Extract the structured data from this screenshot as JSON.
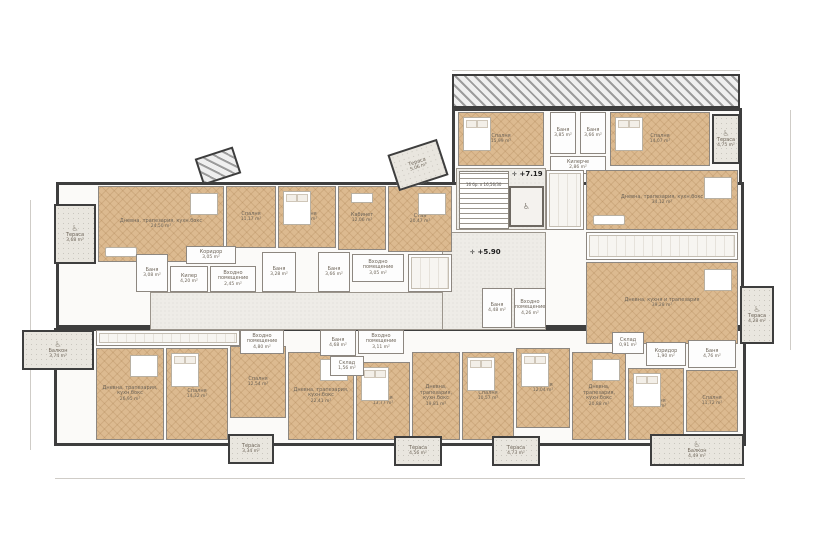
{
  "plan": {
    "title": "Floor plan",
    "unit": "m²",
    "icons": {
      "wheelchair": "♿",
      "marker": "✛",
      "lift": "♿"
    },
    "markers": [
      {
        "label": "+7.19"
      },
      {
        "label": "+5.90"
      }
    ],
    "stairs_note": "16 бр. х 16,56/30",
    "colors": {
      "wood_floor": "#dcba90",
      "wall": "#3e3e3e",
      "terrace": "#e9e6df",
      "common": "#eeece7",
      "bath": "#fdfdfd"
    },
    "rooms": [
      {
        "name": "Спалня",
        "area": "15,99 m²"
      },
      {
        "name": "Баня",
        "area": "3,85 m²"
      },
      {
        "name": "Баня",
        "area": "3,66 m²"
      },
      {
        "name": "Килерче",
        "area": "2,86 m²"
      },
      {
        "name": "Спалня",
        "area": "14,07 m²"
      },
      {
        "name": "Тераса",
        "area": "4,75 m²"
      },
      {
        "name": "Дневна, трапезария, кухн.бокс",
        "area": "34,12 m²"
      },
      {
        "name": "Дневна, кухня и трапезария",
        "area": "39,28 m²"
      },
      {
        "name": "Тераса",
        "area": "4,28 m²"
      },
      {
        "name": "Тераса",
        "area": "3,68 m²"
      },
      {
        "name": "Дневна, трапезария, кухн.бокс",
        "area": "24,50 m²"
      },
      {
        "name": "Спалня",
        "area": "11,17 m²"
      },
      {
        "name": "Спалня",
        "area": "15,57 m²"
      },
      {
        "name": "Кабинет",
        "area": "12,06 m²"
      },
      {
        "name": "Стая",
        "area": "20,47 m²"
      },
      {
        "name": "Тераса",
        "area": "5,06 m²"
      },
      {
        "name": "Коридор",
        "area": "3,05 m²"
      },
      {
        "name": "Килер",
        "area": "4,20 m²"
      },
      {
        "name": "Баня",
        "area": "3,08 m²"
      },
      {
        "name": "Входно помещение",
        "area": "2,45 m²"
      },
      {
        "name": "Баня",
        "area": "3,28 m²"
      },
      {
        "name": "Баня",
        "area": "3,66 m²"
      },
      {
        "name": "Входно помещение",
        "area": "3,05 m²"
      },
      {
        "name": "Баня",
        "area": "4,48 m²"
      },
      {
        "name": "Входно помещение",
        "area": "4,26 m²"
      },
      {
        "name": "Балкон",
        "area": "3,74 m²"
      },
      {
        "name": "Дневна, трапезария, кухн.бокс",
        "area": "26,95 m²"
      },
      {
        "name": "Спалня",
        "area": "14,32 m²"
      },
      {
        "name": "Спалня",
        "area": "12,54 m²"
      },
      {
        "name": "Дневна, трапезария, кухн.бокс",
        "area": "22,41 m²"
      },
      {
        "name": "Спалня",
        "area": "13,77 m²"
      },
      {
        "name": "Входно помещение",
        "area": "4,80 m²"
      },
      {
        "name": "Баня",
        "area": "4,68 m²"
      },
      {
        "name": "Входно помещение",
        "area": "3,11 m²"
      },
      {
        "name": "Склад",
        "area": "1,56 m²"
      },
      {
        "name": "Дневна, трапезария, кухн.бокс",
        "area": "19,81 m²"
      },
      {
        "name": "Спалня",
        "area": "10,57 m²"
      },
      {
        "name": "Спалня",
        "area": "12,04 m²"
      },
      {
        "name": "Дневна, трапезария, кухн.бокс",
        "area": "20,88 m²"
      },
      {
        "name": "Склад",
        "area": "0,91 m²"
      },
      {
        "name": "Коридор",
        "area": "1,90 m²"
      },
      {
        "name": "Баня",
        "area": "4,76 m²"
      },
      {
        "name": "Спалня",
        "area": "14,02 m²"
      },
      {
        "name": "Спалня",
        "area": "11,72 m²"
      },
      {
        "name": "Балкон",
        "area": "4,49 m²"
      },
      {
        "name": "Тераса",
        "area": "3,34 m²"
      },
      {
        "name": "Тераса",
        "area": "4,56 m²"
      },
      {
        "name": "Тераса",
        "area": "4,73 m²"
      }
    ]
  }
}
